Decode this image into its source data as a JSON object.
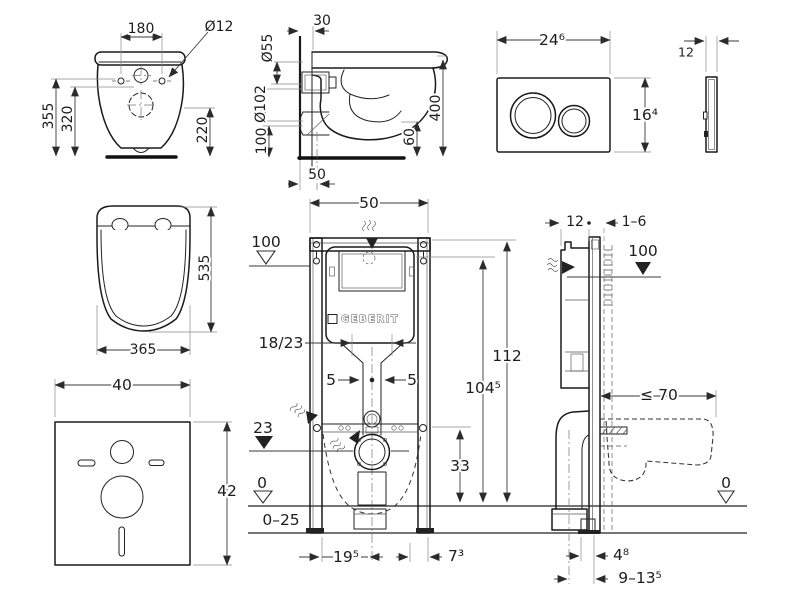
{
  "drawing": {
    "type": "technical-installation-diagram",
    "brand_color": "#1a1a1a"
  },
  "views": {
    "wc_back": {
      "width_between_holes": "180",
      "hole_diameter": "Ø12",
      "height_total": "355",
      "height_mid": "320",
      "height_right": "220"
    },
    "wc_side": {
      "wall_offset": "30",
      "inlet_diameter": "Ø55",
      "outlet_diameter": "Ø102",
      "outlet_height": "100",
      "front_clearance": "60",
      "depth_total": "400",
      "drain_offset": "50"
    },
    "flush_plate": {
      "width": "24⁶",
      "height": "16⁴",
      "thickness": "12"
    },
    "seat": {
      "depth": "535",
      "width": "365"
    },
    "sound_mat": {
      "width": "40",
      "height": "42"
    },
    "frame_front": {
      "width": "50",
      "level_plate": "100",
      "brand": "GEBERIT",
      "flush_bend": "18/23",
      "offset_left": "5",
      "offset_right": "5",
      "height_frame": "112",
      "height_plate": "104⁵",
      "level_drain": "23",
      "drain_height": "33",
      "level_floor": "0",
      "floor_buildup": "0–25",
      "foot_left": "19⁵",
      "foot_right": "7³"
    },
    "frame_side": {
      "frame_depth": "12",
      "finish_thickness": "1–6",
      "level_plate": "100",
      "pan_depth": "≤ 70",
      "level_floor": "0",
      "foot_depth": "4⁸",
      "drain_offset": "9–13⁵"
    }
  }
}
